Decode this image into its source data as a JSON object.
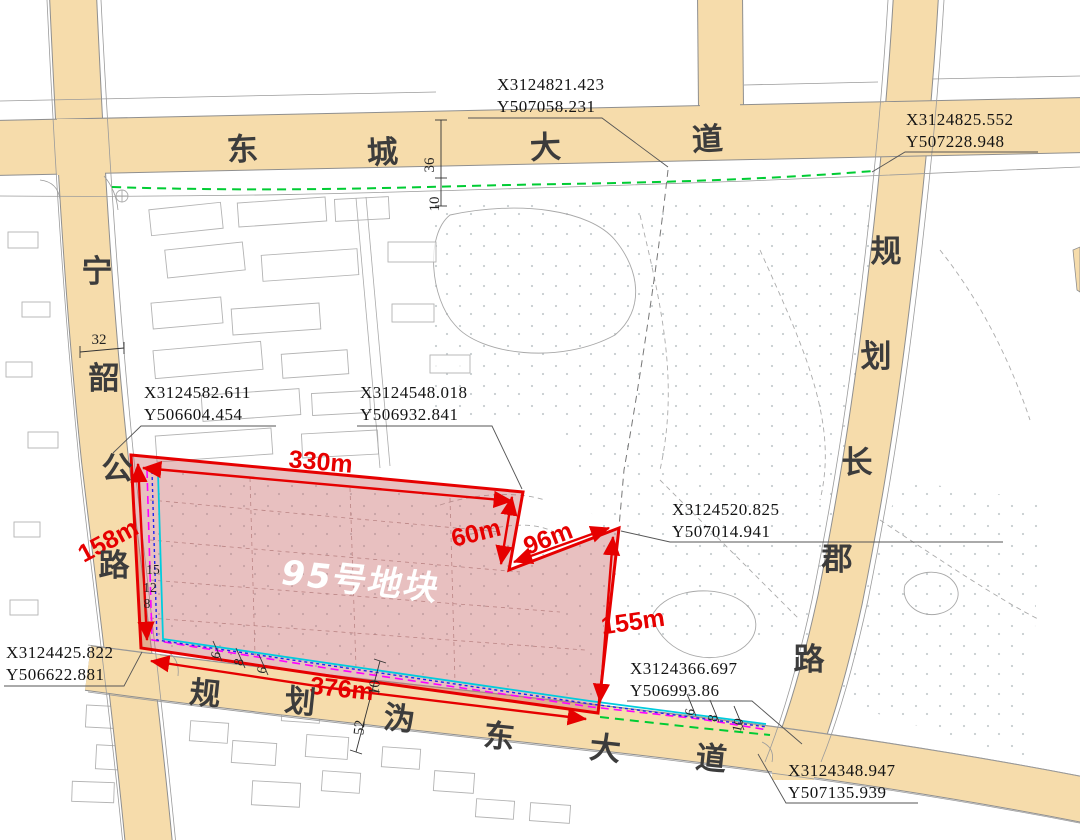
{
  "map": {
    "parcel": {
      "label": "95号地块"
    },
    "dimensions": {
      "top": "330m",
      "left": "158m",
      "notch_vertical": "60m",
      "notch_diagonal": "96m",
      "right": "155m",
      "bottom": "376m"
    },
    "roads": {
      "top": {
        "name": "东城大道",
        "chars": [
          "东",
          "城",
          "大",
          "道"
        ]
      },
      "left": {
        "name": "宁韶公路",
        "chars": [
          "宁",
          "韶",
          "公",
          "路"
        ]
      },
      "right": {
        "name": "规划长郡路",
        "chars": [
          "规",
          "划",
          "长",
          "郡",
          "路"
        ]
      },
      "bottom": {
        "name": "规划沩东大道",
        "chars": [
          "规",
          "划",
          "沩",
          "东",
          "大",
          "道"
        ]
      }
    },
    "coord_labels": [
      {
        "x": "X3124821.423",
        "y": "Y507058.231"
      },
      {
        "x": "X3124825.552",
        "y": "Y507228.948"
      },
      {
        "x": "X3124582.611",
        "y": "Y506604.454"
      },
      {
        "x": "X3124548.018",
        "y": "Y506932.841"
      },
      {
        "x": "X3124520.825",
        "y": "Y507014.941"
      },
      {
        "x": "X3124366.697",
        "y": "Y506993.86"
      },
      {
        "x": "X3124425.822",
        "y": "Y506622.881"
      },
      {
        "x": "X3124348.947",
        "y": "Y507135.939"
      }
    ],
    "measurements": {
      "top_road_width": "36",
      "top_green_offset": "10",
      "left_road_width": "32",
      "bottom_road_width": "52",
      "bottom_green_offset": "10",
      "left_line_offsets": [
        "15",
        "12",
        "8"
      ],
      "bottom_left_line_offsets": [
        "6",
        "8",
        "6"
      ],
      "bottom_right_line_offsets": [
        "6",
        "8",
        "10"
      ]
    },
    "colors": {
      "road_fill": "#f6dcab",
      "parcel_fill": "#c96a6a",
      "boundary_red": "#e60000",
      "green_line": "#00cc33",
      "magenta_line": "#ff00ff",
      "blue_line": "#2222ee",
      "cyan_line": "#00ccdd"
    }
  }
}
